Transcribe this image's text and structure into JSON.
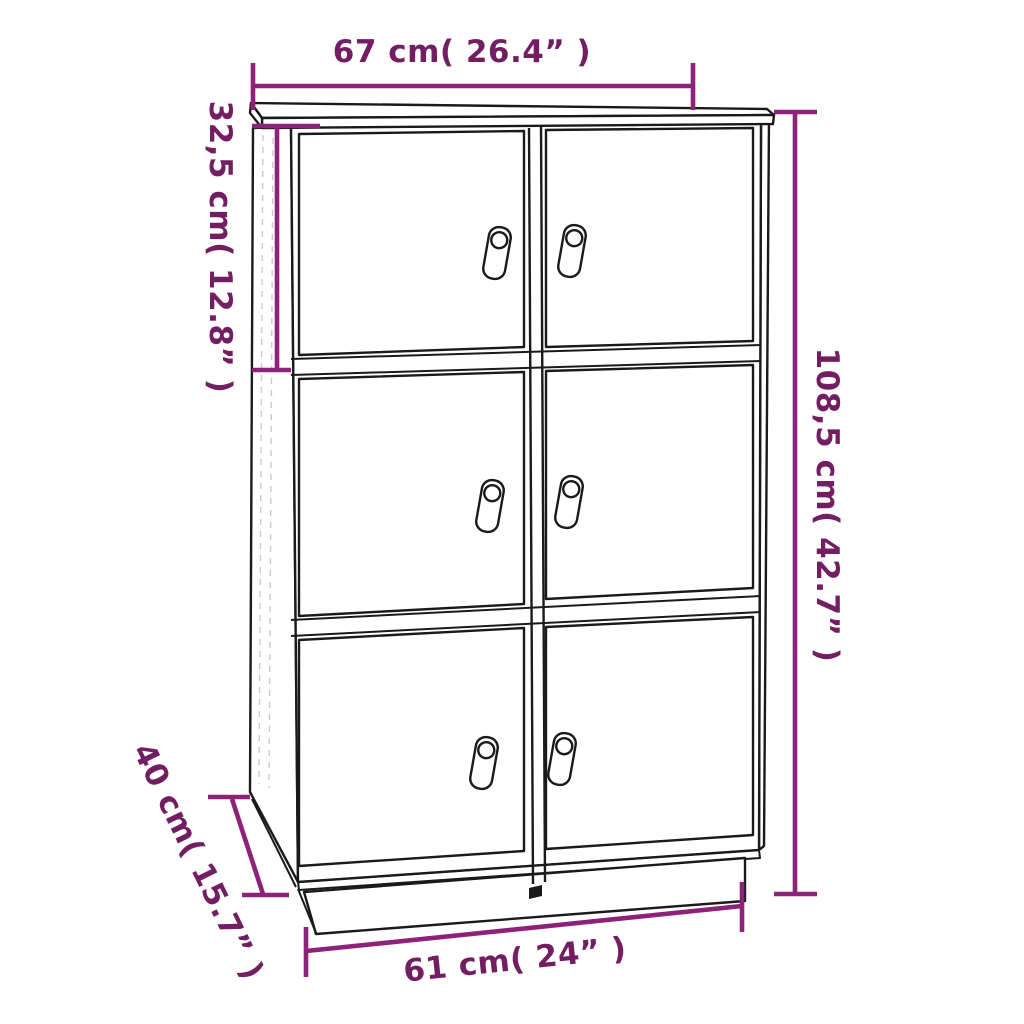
{
  "figure": {
    "title": "Cabinet dimensions diagram",
    "product": "Storage cabinet with 6 doors and leather pull handles",
    "door_count": 6,
    "background": "#ffffff",
    "colors": {
      "dimension_line": "#8E2178",
      "dimension_text": "#731D62",
      "line_art": "#1a1a1a"
    },
    "dimensions": {
      "top_width": "67 cm( 26.4” )",
      "upper_height": "32,5 cm( 12.8” )",
      "total_height": "108,5 cm( 42.7” )",
      "depth": "40 cm( 15.7” )",
      "bottom_width": "61 cm( 24” )"
    }
  }
}
